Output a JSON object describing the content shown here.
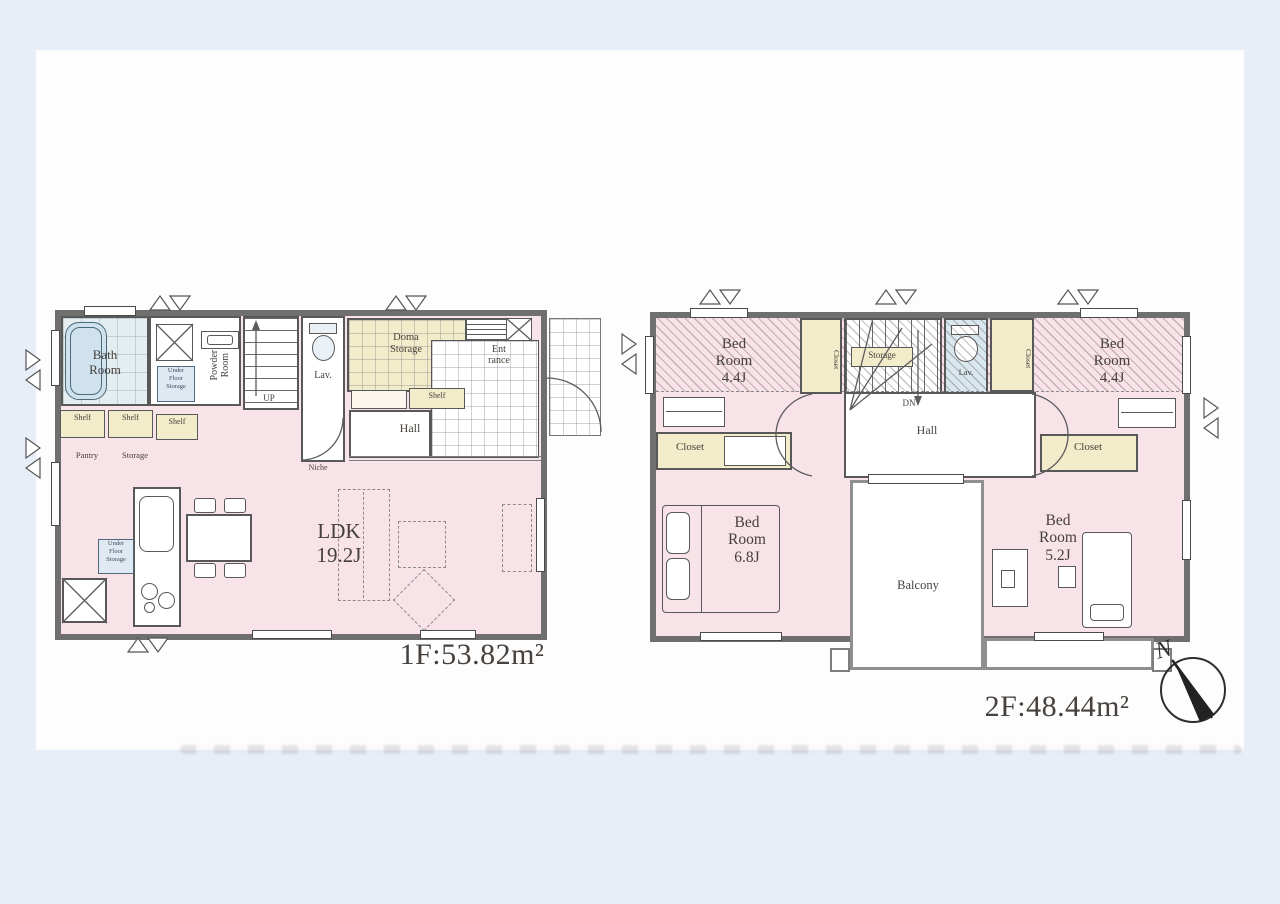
{
  "colors": {
    "room_pink": "#f7e3e8",
    "closet_cream": "#f3ecca",
    "bath_blue": "#e4edf0",
    "lav_blue": "#d9e7ef",
    "wall_gray": "#6f6f6f",
    "line_gray": "#585858",
    "label_ink": "#46413c",
    "paper_white": "#fdfdfe",
    "bg_blue": "#e8eef7",
    "uf_blue": "#dfe9f2"
  },
  "floor1": {
    "area_label": "1F:53.82m²",
    "bath_room": "Bath\nRoom",
    "powder_room": "Powder\nRoom",
    "under_floor_storage_powder": "Under\nFloor\nStorage",
    "up_label": "UP",
    "lav_label": "Lav.",
    "doma_storage": "Doma\nStorage",
    "shelves": [
      "Shelf",
      "Shelf",
      "Shelf",
      "Shelf"
    ],
    "pantry_label": "Pantry",
    "storage_label": "Storage",
    "entrance_label": "Ent\nrance",
    "hall_label": "Hall",
    "niche_label": "Niche",
    "ldk_label": "LDK\n19.2J",
    "under_floor_storage_kitchen": "Under\nFloor\nStorage"
  },
  "floor2": {
    "area_label": "2F:48.44m²",
    "bedroom_top_left": "Bed\nRoom\n4.4J",
    "bedroom_top_right": "Bed\nRoom\n4.4J",
    "bedroom_bottom_left": "Bed\nRoom\n6.8J",
    "bedroom_bottom_right": "Bed\nRoom\n5.2J",
    "closet_strip_left": "Closet",
    "closet_strip_right": "Closet",
    "closet_room_left": "Closet",
    "closet_room_right": "Closet",
    "stair_storage_label": "Storage",
    "dn_label": "DN",
    "lav_label": "Lav.",
    "hall_label": "Hall",
    "balcony_label": "Balcony"
  },
  "compass": {
    "north_label": "N"
  }
}
